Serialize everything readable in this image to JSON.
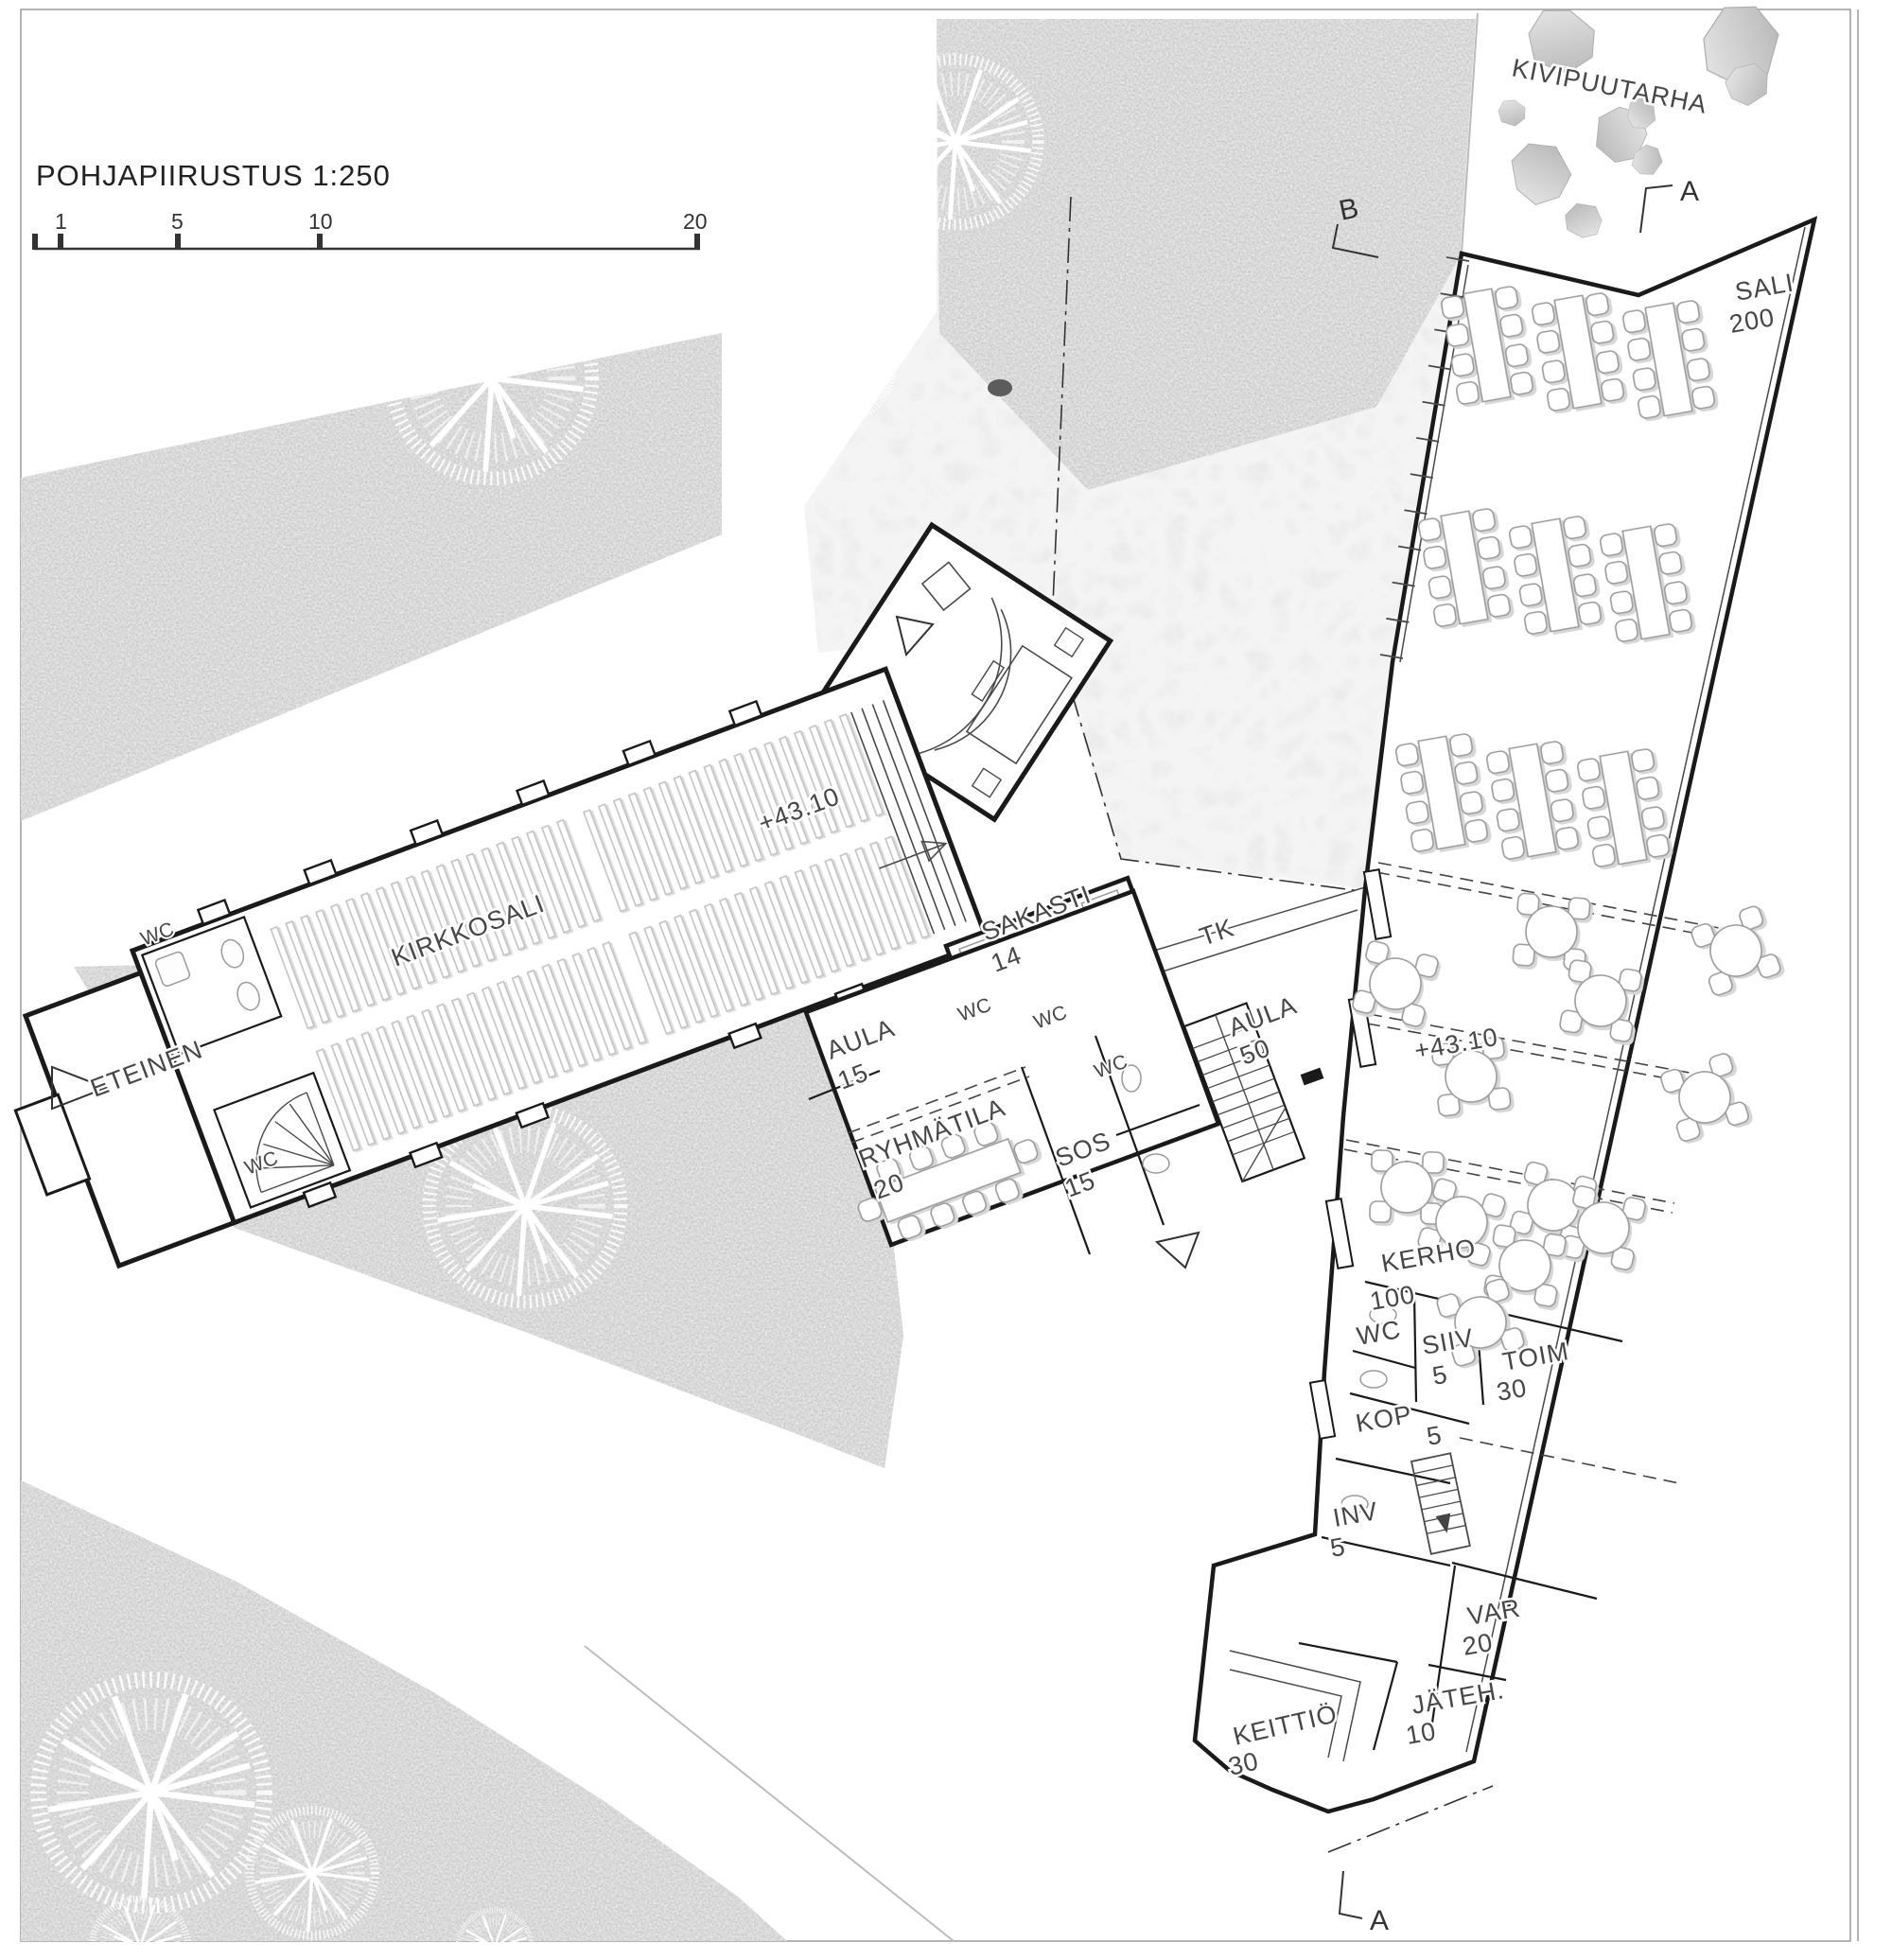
{
  "title": "POHJAPIIRUSTUS   1:250",
  "scale_bar": {
    "labels": [
      "1",
      "5",
      "10",
      "20"
    ]
  },
  "section_markers": {
    "top_a": "A",
    "top_b": "B",
    "bottom_a": "A"
  },
  "site": {
    "stone_garden": "KIVIPUUTARHA",
    "walkway": "TK"
  },
  "elevation": {
    "church": "+43.10",
    "wing": "+43.10"
  },
  "wc_label": "WC",
  "rooms": {
    "sali": {
      "name": "SALI",
      "capacity": "200"
    },
    "kirkkosali": {
      "name": "KIRKKOSALI"
    },
    "eteinen": {
      "name": "ETEINEN"
    },
    "sakasti": {
      "name": "SAKASTI",
      "capacity": "14"
    },
    "aula_upper": {
      "name": "AULA",
      "capacity": "15"
    },
    "ryhmatila": {
      "name": "RYHMÄTILA",
      "capacity": "20"
    },
    "sos": {
      "name": "SOS",
      "capacity": "15"
    },
    "aula_lower": {
      "name": "AULA",
      "capacity": "50"
    },
    "kerho": {
      "name": "KERHO",
      "capacity": "100"
    },
    "siiv": {
      "name": "SIIV",
      "capacity": "5"
    },
    "toim": {
      "name": "TOIM",
      "capacity": "30"
    },
    "kop": {
      "name": "KOP",
      "capacity": "5"
    },
    "inv": {
      "name": "INV",
      "capacity": "5"
    },
    "var": {
      "name": "VAR",
      "capacity": "20"
    },
    "jateh": {
      "name": "JÄTEH.",
      "capacity": "10"
    },
    "keittio": {
      "name": "KEITTIÖ",
      "capacity": "30"
    }
  }
}
